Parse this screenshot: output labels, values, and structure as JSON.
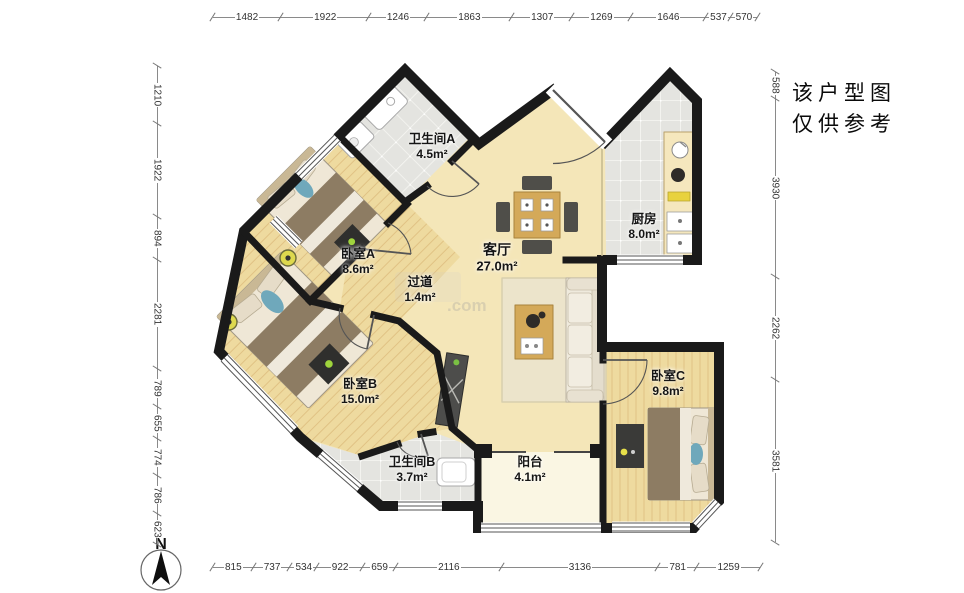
{
  "annotation": {
    "line1": "该户型图",
    "line2": "仅供参考"
  },
  "compass": {
    "label": "N"
  },
  "watermark": {
    "text": ".com"
  },
  "dimensions": {
    "top": [
      1482,
      1922,
      1246,
      1863,
      1307,
      1269,
      1646,
      537,
      570
    ],
    "left": [
      1210,
      1922,
      894,
      2281,
      789,
      655,
      774,
      786,
      623
    ],
    "right": [
      588,
      3930,
      2262,
      3581
    ],
    "bottom": [
      815,
      737,
      534,
      922,
      659,
      2116,
      3136,
      781,
      1259
    ]
  },
  "rooms": [
    {
      "id": "bathroom-a",
      "name": "卫生间A",
      "area": "4.5m²"
    },
    {
      "id": "bedroom-a",
      "name": "卧室A",
      "area": "8.6m²"
    },
    {
      "id": "hallway",
      "name": "过道",
      "area": "1.4m²"
    },
    {
      "id": "living-room",
      "name": "客厅",
      "area": "27.0m²"
    },
    {
      "id": "kitchen",
      "name": "厨房",
      "area": "8.0m²"
    },
    {
      "id": "bedroom-b",
      "name": "卧室B",
      "area": "15.0m²"
    },
    {
      "id": "bathroom-b",
      "name": "卫生间B",
      "area": "3.7m²"
    },
    {
      "id": "balcony",
      "name": "阳台",
      "area": "4.1m²"
    },
    {
      "id": "bedroom-c",
      "name": "卧室C",
      "area": "9.8m²"
    }
  ],
  "colors": {
    "wall": "#1a1a1a",
    "floor_light": "#f4e6b8",
    "floor_plank": "#eeda9f",
    "tile": "#e4e4e0",
    "balcony": "#faf6e3",
    "furniture_wood": "#d4a959",
    "blanket": "#8d7c63",
    "accent_teal": "#6fa8bb",
    "accent_green": "#9fd43c"
  }
}
